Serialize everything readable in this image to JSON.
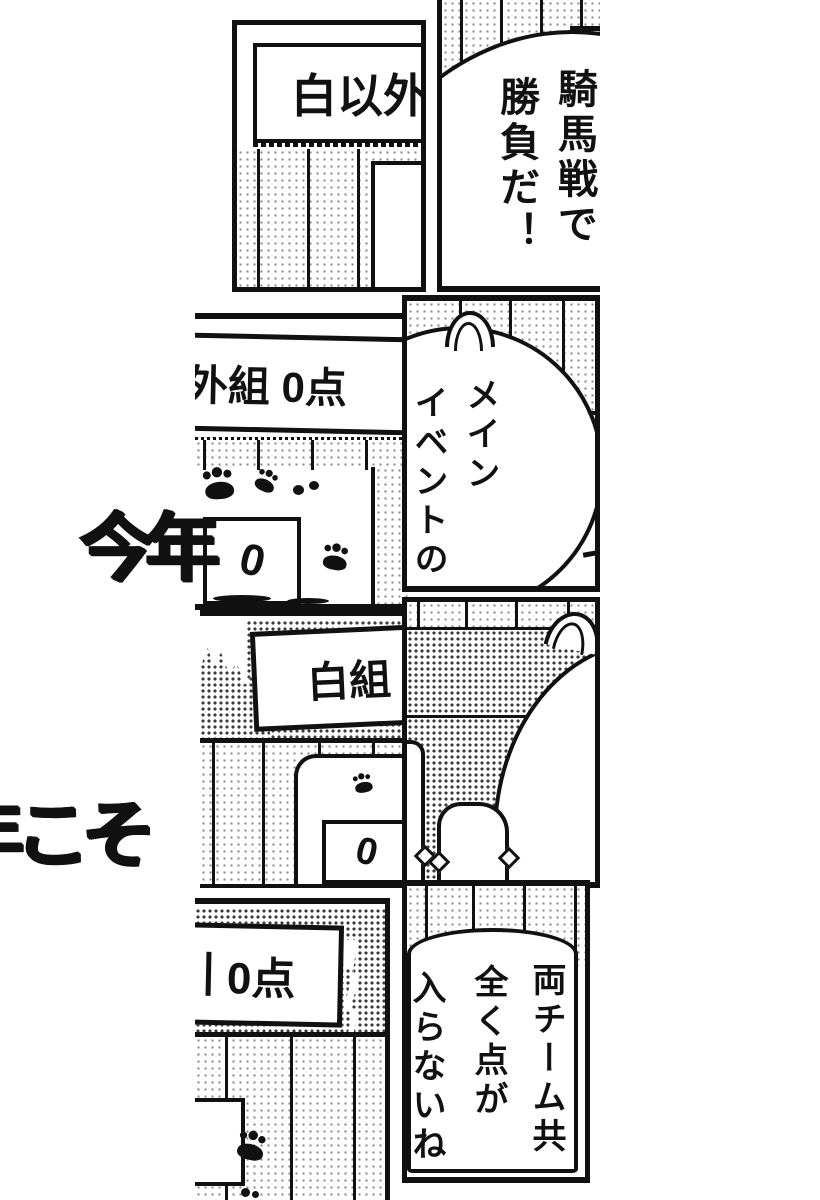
{
  "colors": {
    "ink": "#111111",
    "paper": "#ffffff"
  },
  "background_text": {
    "top_fragment": "今年",
    "bottom_fragment": "年こそ"
  },
  "signs": {
    "top_left": "白以外",
    "row2": "外組 0点",
    "row3": "白組",
    "row4": "0点"
  },
  "scoreboards": {
    "row2_value": "0",
    "row3_value": "0"
  },
  "speech_bubbles": {
    "top_right": {
      "columns": [
        "騎馬戦で",
        "勝負だ！"
      ]
    },
    "row2_right": {
      "columns": [
        "メイン",
        "イベントの"
      ]
    },
    "bottom_right": {
      "columns": [
        "両チーム共",
        "全く点が",
        "入らないね"
      ]
    }
  }
}
